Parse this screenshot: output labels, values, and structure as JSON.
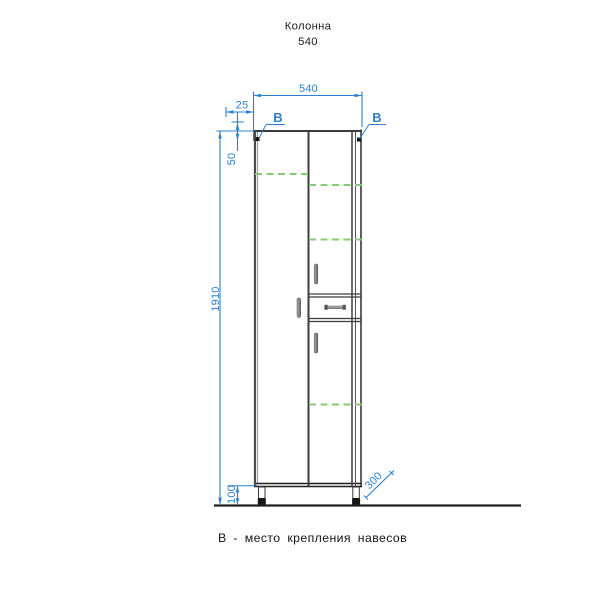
{
  "title": {
    "line1": "Колонна",
    "line2": "540"
  },
  "dims": {
    "width": "540",
    "marker_offset_x": "25",
    "marker_offset_y": "50",
    "total_height": "1910",
    "leg_height": "100",
    "depth": "300"
  },
  "markers": {
    "left": "B",
    "right": "B"
  },
  "caption": {
    "text": "В - место крепления навесов"
  },
  "colors": {
    "dimension_blue": "#2b7fd9",
    "drawing_dark": "#1f1f1f",
    "drawing_gray": "#4a4a4a",
    "shelf_green": "#84cd72",
    "handle_gray": "#8a8a8a",
    "background": "#ffffff"
  }
}
